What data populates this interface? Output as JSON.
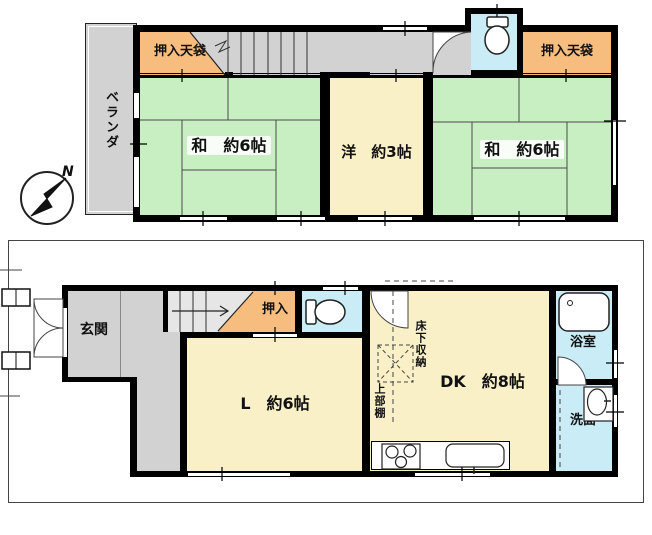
{
  "title": "floor-plan",
  "compass": {
    "north_label": "N"
  },
  "floor2": {
    "veranda": "ベランダ",
    "closet_left": "押入天袋",
    "closet_right": "押入天袋",
    "room_japanese_left": "和　約6帖",
    "room_western": "洋　約3帖",
    "room_japanese_right": "和　約6帖"
  },
  "floor1": {
    "entrance": "玄関",
    "closet": "押入",
    "living": "L　約6帖",
    "dining_kitchen": "DK　約8帖",
    "underfloor_storage": "床下収納",
    "upper_shelf": "上部棚",
    "bathroom": "浴室",
    "washroom": "洗面"
  },
  "colors": {
    "tatami_green": "#c8efc2",
    "cream": "#faf0c8",
    "closet_orange": "#f6bd7e",
    "water_blue": "#c9ecf6",
    "floor_gray": "#d2d2d2",
    "wall_black": "#000000"
  }
}
